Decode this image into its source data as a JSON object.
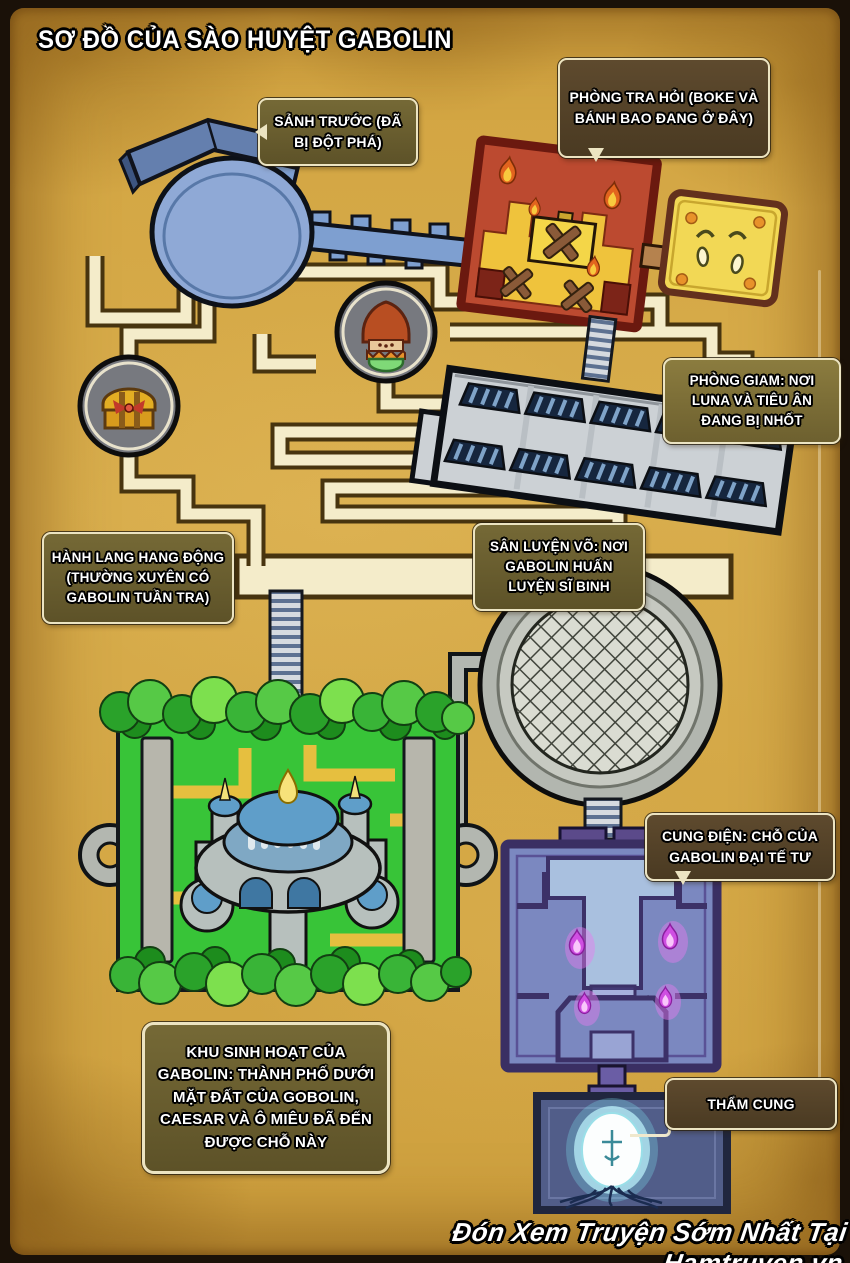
{
  "page": {
    "title": "SƠ ĐỒ CỦA SÀO HUYỆT GABOLIN",
    "watermark": "Đón Xem Truyện Sớm Nhất Tại Hamtruyen.vn"
  },
  "labels": {
    "front_hall": "SẢNH TRƯỚC (ĐÃ BỊ ĐỘT PHÁ)",
    "interrogation_room": "PHÒNG TRA HỎI (BOKE VÀ BÁNH BAO ĐANG Ở ĐÂY)",
    "prison": "PHÒNG GIAM: NƠI LUNA VÀ TIÊU ÂN ĐANG BỊ NHỐT",
    "cave_corridor": "HÀNH LANG HANG ĐỘNG (THƯỜNG XUYÊN CÓ GABOLIN TUẦN TRA)",
    "training_yard": "SÂN LUYỆN VÕ: NƠI GABOLIN HUẤN LUYỆN SĨ BINH",
    "palace": "CUNG ĐIỆN: CHỖ CỦA GABOLIN ĐẠI TẾ TƯ",
    "living_area": "KHU SINH HOẠT CỦA GABOLIN: THÀNH PHỐ DƯỚI MẶT ĐẤT CỦA GOBOLIN, CAESAR VÀ Ô MIÊU ĐÃ ĐẾN ĐƯỢC CHỖ NÀY",
    "inner_sanctum": "THẨM CUNG"
  },
  "colors": {
    "parchment": "#d5a845",
    "label_box_olive": "#6b6034",
    "label_box_brown": "#55422a",
    "structure_blue": "#7e9fd0",
    "room_red": "#bc4a30",
    "room_yellow": "#f2d855",
    "garden_green": "#38c438",
    "palace_purple": "#7b88c0",
    "flame_orange": "#e2641e",
    "flame_pink": "#d857e8",
    "orb_glow": "#8ae4f5"
  },
  "icons": {
    "treasure_chest": "treasure-chest-icon",
    "bun_creature": "bun-creature-icon",
    "crying_face": "crying-face-icon",
    "flame": "flame-icon",
    "glowing_orb": "glowing-orb-icon"
  }
}
